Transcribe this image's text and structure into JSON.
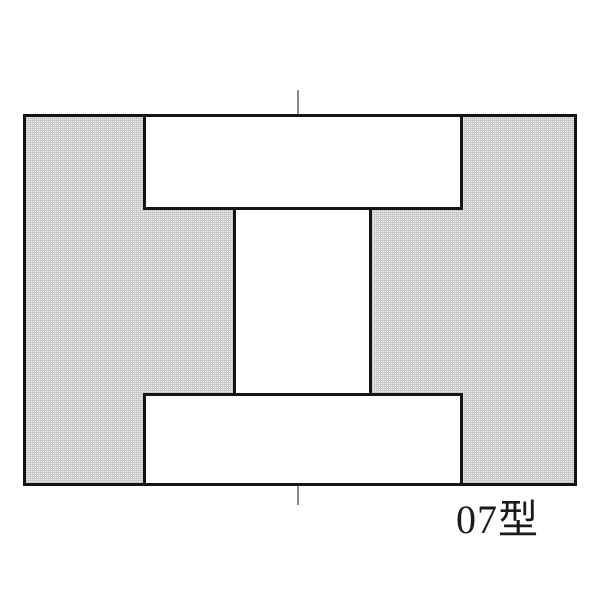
{
  "diagram": {
    "title": "07型",
    "kind": "core-cross-section-drawing",
    "colors": {
      "page_bg": "#ffffff",
      "outline": "#141414",
      "fill": "#efefef",
      "fill_mesh_line": "#c9c9c9",
      "cutout": "#ffffff",
      "centerline": "#8a8a8a",
      "label_text": "#1a1a1a"
    }
  }
}
